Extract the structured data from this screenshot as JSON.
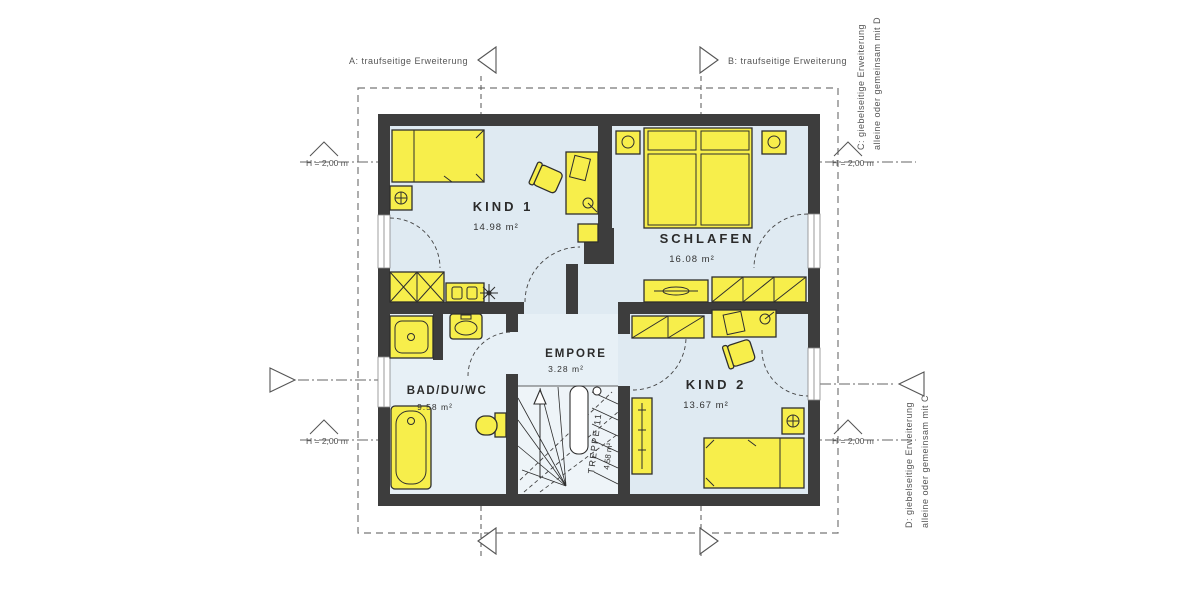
{
  "plan": {
    "title": "Obergeschoss Grundriss",
    "rooms": {
      "kind1": {
        "name": "KIND 1",
        "area": "14.98 m²"
      },
      "schlafen": {
        "name": "SCHLAFEN",
        "area": "16.08 m²"
      },
      "empore": {
        "name": "EMPORE",
        "area": "3.28 m²"
      },
      "bad": {
        "name": "BAD/DU/WC",
        "area": "9.58 m²"
      },
      "kind2": {
        "name": "KIND 2",
        "area": "13.67 m²"
      },
      "treppe": {
        "name": "TREPPE 11",
        "area": "4.58 m²"
      }
    },
    "annotations": {
      "a": "A: traufseitige Erweiterung",
      "b": "B: traufseitige Erweiterung",
      "c1": "C: giebelseitige Erweiterung",
      "c2": "alleine oder gemeinsam mit D",
      "d1": "D: giebelseitige Erweiterung",
      "d2": "alleine oder gemeinsam mit C",
      "height": "H = 2,00 m"
    },
    "colors": {
      "wall": "#3d3d3d",
      "floor": "#dfeaf2",
      "furniture": "#f7ee4b",
      "background": "#ffffff"
    }
  }
}
